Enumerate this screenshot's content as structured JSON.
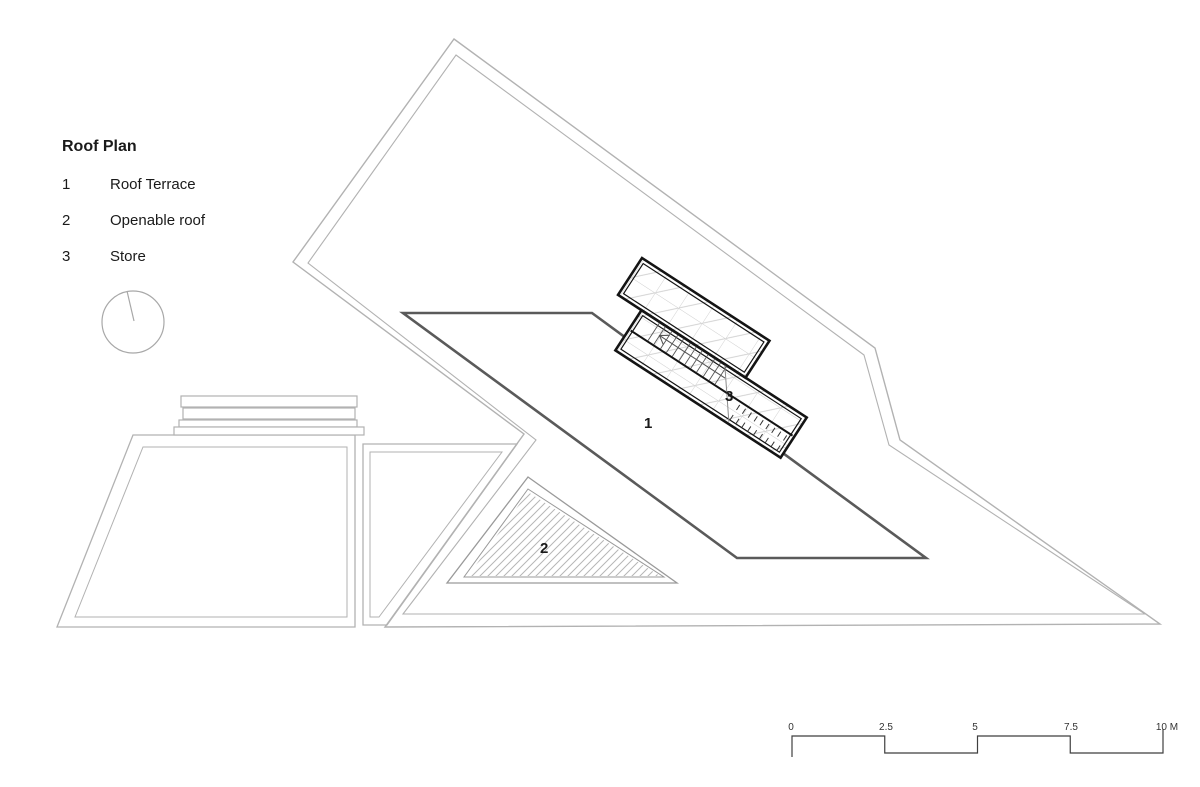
{
  "drawing": {
    "type": "architectural-roof-plan"
  },
  "legend": {
    "title": "Roof Plan",
    "items": [
      {
        "num": "1",
        "label": "Roof Terrace"
      },
      {
        "num": "2",
        "label": "Openable roof"
      },
      {
        "num": "3",
        "label": "Store"
      }
    ]
  },
  "plan": {
    "labels": [
      "1",
      "2",
      "3"
    ]
  },
  "scale_bar": {
    "labels": [
      "0",
      "2.5",
      "5",
      "7.5",
      "10 M"
    ],
    "unit": "M"
  },
  "colors": {
    "background": "#ffffff",
    "light_outline": "#b2b2b2",
    "terrace_edge": "#5a5a5a",
    "block_wall": "#141414",
    "grid_line": "#cfcfcf",
    "hatch_line": "#b6b6b6",
    "scale_line": "#3f3f3f",
    "north_line": "#a8a8a8",
    "text": "#1a1a1a"
  }
}
